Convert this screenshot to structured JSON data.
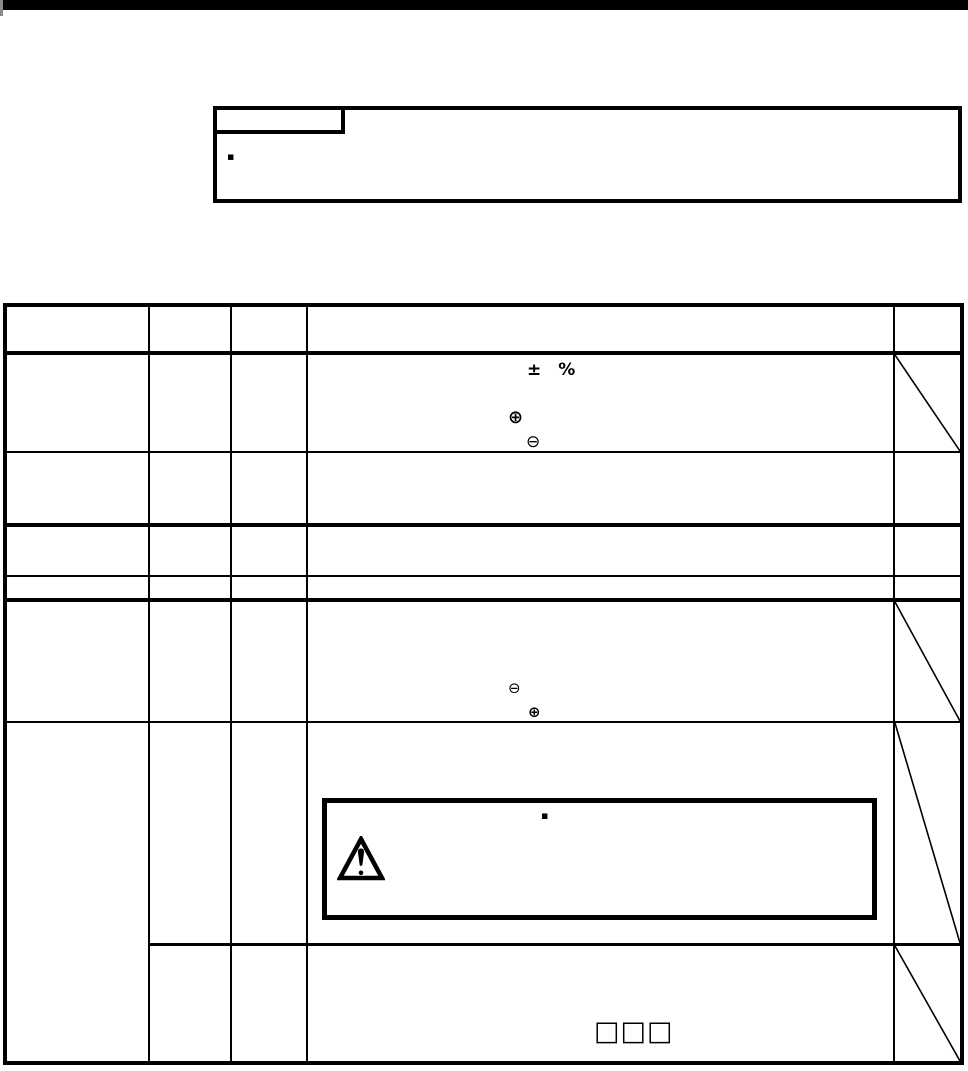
{
  "colors": {
    "paper": "#ffffff",
    "ink": "#000000",
    "top_bar": "#000000"
  },
  "top_bar": {
    "present": true
  },
  "callout_box": {
    "tab_label": "",
    "bullet": "▪",
    "body_text": ""
  },
  "table": {
    "columns": 5,
    "header_labels": [
      "",
      "",
      "",
      "",
      ""
    ],
    "row1": {
      "tolerance_sign": "±",
      "tolerance_unit": "%",
      "terminal_plus": "⊕",
      "terminal_minus": "⊖",
      "diagonal_in_last_column": true
    },
    "row5": {
      "terminal_minus": "⊖",
      "terminal_plus": "⊕",
      "diagonal_in_last_column": true
    },
    "caution": {
      "bullet": "▪",
      "icon": "warning-triangle",
      "text": ""
    },
    "row7": {
      "model_boxes": "□□□",
      "diagonal_in_last_column": true
    }
  }
}
